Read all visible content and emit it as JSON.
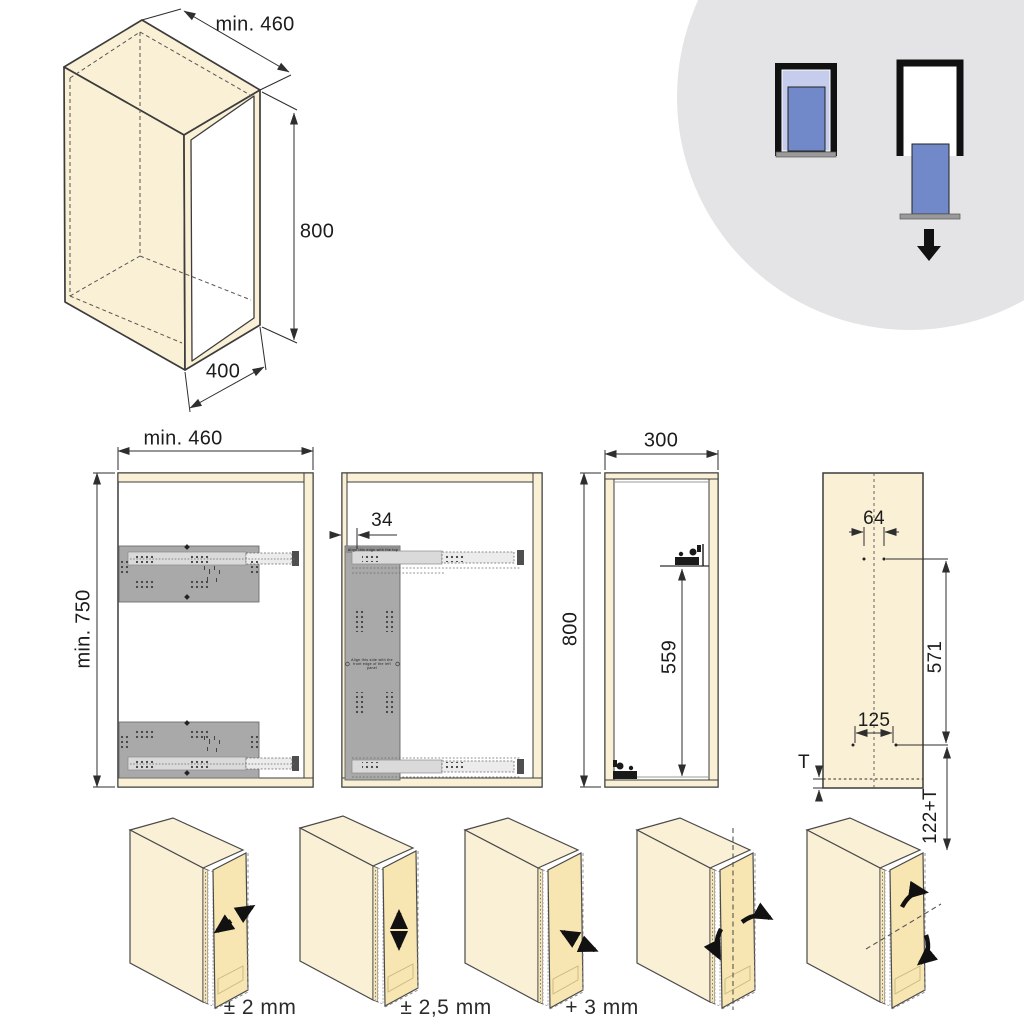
{
  "title": "Pull-out cabinet installation diagram",
  "colors": {
    "wood": "#faf0d5",
    "wood_door": "#f7e5b2",
    "plate_gray": "#a9a9a9",
    "rail_light": "#dadada",
    "circle_gray": "#e4e4e6",
    "blue": "#7289c9",
    "blue_light": "#c6cceb",
    "bar_gray": "#9a9a9a",
    "line": "#3c3c3c"
  },
  "iso_cabinet": {
    "width": "min. 460",
    "height": "800",
    "depth": "400"
  },
  "panel_side": {
    "width": "min. 460",
    "height": "min. 750"
  },
  "panel_template": {
    "offset": "34",
    "note_top": "Align this edge with the top",
    "note_center": "Align this side with the front edge of the left panel"
  },
  "panel_front": {
    "width": "300",
    "height": "800",
    "bracket_height": "559"
  },
  "panel_door": {
    "top_hole_spacing": "64",
    "hole_span": "571",
    "bottom_hole_spacing": "125",
    "thickness": "T",
    "overhang": "122+T"
  },
  "adjustment_labels": [
    "± 2 mm",
    "± 2,5 mm",
    "+ 3 mm"
  ]
}
